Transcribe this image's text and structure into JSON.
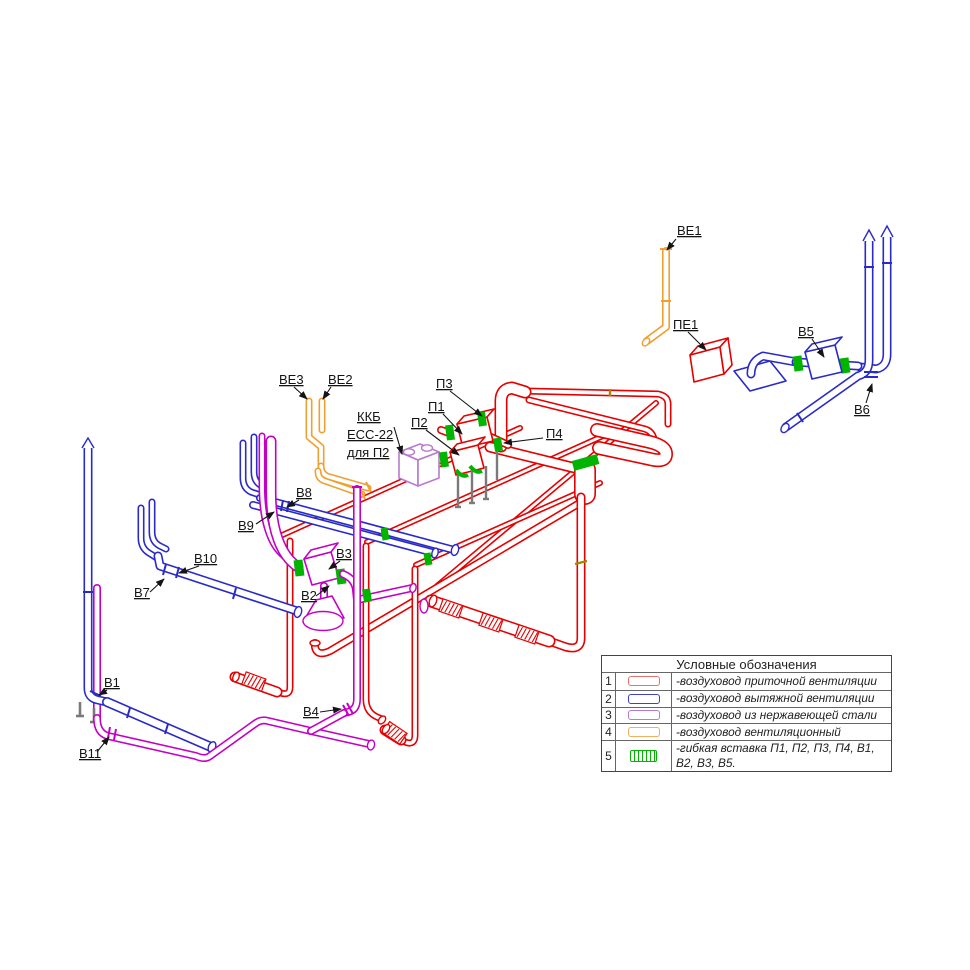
{
  "colors": {
    "red": "#e60000",
    "blue": "#2a2ac8",
    "magenta": "#c400c4",
    "violet": "#b87ad0",
    "orange": "#f0a030",
    "green": "#00b400"
  },
  "diagram": {
    "labels": {
      "ve1": "ВЕ1",
      "pe1": "ПЕ1",
      "v5": "В5",
      "v6": "В6",
      "ve3": "ВЕ3",
      "ve2": "ВЕ2",
      "kkb1": "ККБ",
      "kkb2": "ЕСС-22",
      "kkb3": "для П2",
      "p3": "П3",
      "p1": "П1",
      "p2": "П2",
      "p4": "П4",
      "v8": "В8",
      "v9": "В9",
      "v10": "В10",
      "v7": "В7",
      "v3": "В3",
      "v2": "В2",
      "v1": "В1",
      "v11": "В11",
      "v4": "В4"
    }
  },
  "legend": {
    "title": "Условные обозначения",
    "rows": [
      {
        "num": "1",
        "desc": "-воздуховод приточной вентиляции",
        "color": "#e87070",
        "style": "plain"
      },
      {
        "num": "2",
        "desc": "-воздуховод вытяжной вентиляции",
        "color": "#4040c8",
        "style": "plain"
      },
      {
        "num": "3",
        "desc": "-воздуховод из нержавеющей стали",
        "color": "#b87ad0",
        "style": "plain"
      },
      {
        "num": "4",
        "desc": "-воздуховод вентиляционный",
        "color": "#f0b060",
        "style": "plain"
      },
      {
        "num": "5",
        "desc": "-гибкая вставка П1, П2, П3, П4, В1, В2, В3, В5.",
        "color": "#00b400",
        "style": "hatch"
      }
    ]
  }
}
